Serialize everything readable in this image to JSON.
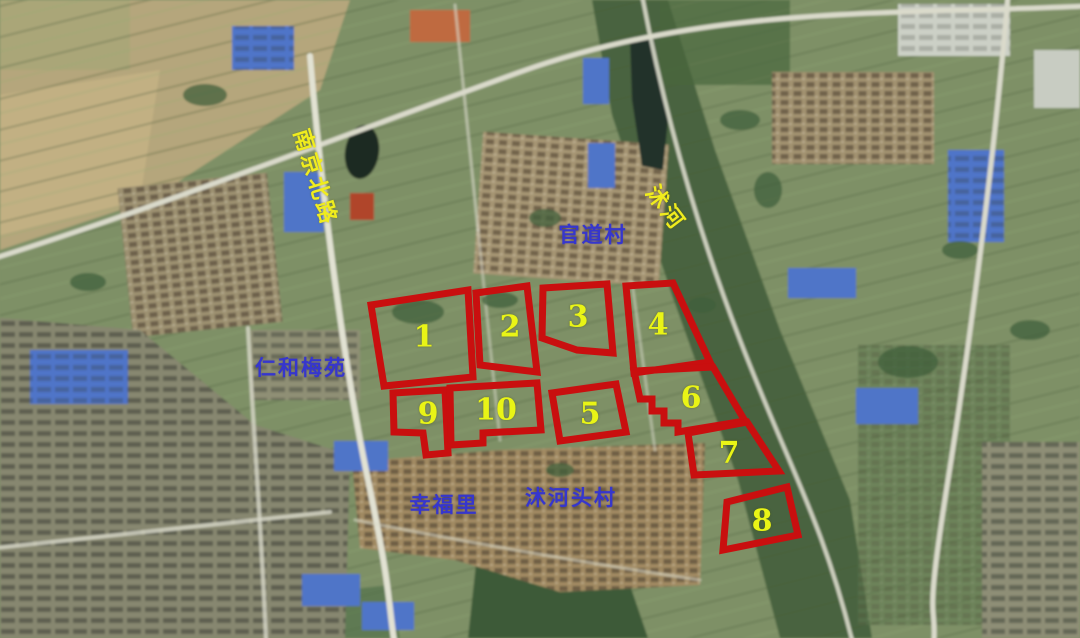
{
  "map": {
    "description": "Annotated satellite map with ten numbered red land parcels",
    "colors": {
      "parcel_outline": "#c90f0f",
      "parcel_number": "#e9f416",
      "road_label": "#f0ec1e",
      "place_label": "#3636cd"
    },
    "road_labels": [
      {
        "id": "nanjing-north-road",
        "text": "南京北路",
        "rotation_deg": 73
      },
      {
        "id": "shu-river",
        "text": "沭河",
        "rotation_deg": 53
      }
    ],
    "place_labels": [
      {
        "id": "guandao-village",
        "text": "官道村"
      },
      {
        "id": "renhe-meiyuan",
        "text": "仁和梅苑"
      },
      {
        "id": "xingfuli",
        "text": "幸福里"
      },
      {
        "id": "shuhetou-village",
        "text": "沭河头村"
      }
    ],
    "parcels": [
      {
        "number": "1",
        "points": "371,305 468,290 473,377 384,386"
      },
      {
        "number": "2",
        "points": "476,293 527,286 537,372 480,365"
      },
      {
        "number": "3",
        "points": "543,288 607,284 613,353 577,350 542,338"
      },
      {
        "number": "4",
        "points": "626,286 673,283 710,362 634,373"
      },
      {
        "number": "5",
        "points": "552,393 616,384 626,432 560,441"
      },
      {
        "number": "6",
        "points": "634,371 713,367 745,421 678,432 678,423 664,423 664,411 652,411 652,399 640,399"
      },
      {
        "number": "7",
        "points": "688,433 747,422 779,471 694,475"
      },
      {
        "number": "8",
        "points": "727,502 787,487 798,535 723,550"
      },
      {
        "number": "9",
        "points": "393,393 445,390 448,453 426,455 423,433 394,432"
      },
      {
        "number": "10",
        "points": "450,388 537,383 541,430 483,433 483,443 451,445"
      }
    ]
  }
}
